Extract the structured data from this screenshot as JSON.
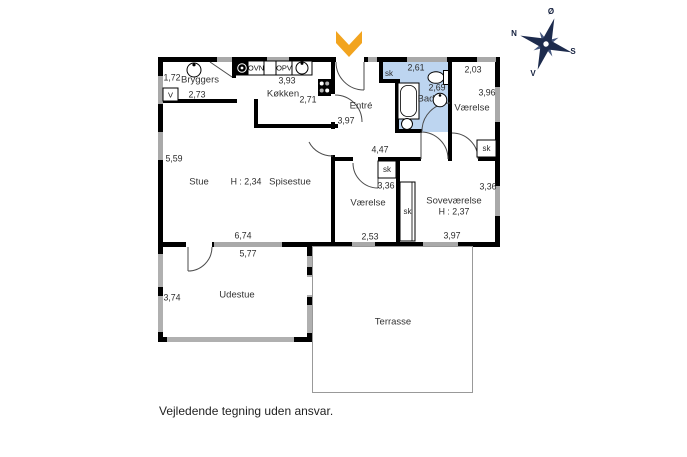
{
  "disclaimer": "Vejledende tegning uden ansvar.",
  "compass": {
    "north": "N",
    "south": "S",
    "east": "Ø",
    "west": "V"
  },
  "labels": {
    "oven": "OVN",
    "dishwasher": "OPV",
    "ventilation": "V",
    "closet": "sk"
  },
  "rooms": {
    "bryggers": {
      "name": "Bryggers",
      "width": "2,73",
      "depth": "1,72"
    },
    "kokken": {
      "name": "Køkken",
      "width": "3,93",
      "depth": "2,71"
    },
    "entre": {
      "name": "Entré",
      "depth": "3,97"
    },
    "bad": {
      "name": "Bad",
      "width": "2,61",
      "depth": "2,69"
    },
    "vaerelse_ne": {
      "name": "Værelse",
      "width": "2,03",
      "depth": "3,96"
    },
    "hall": {
      "width": "4,47"
    },
    "stue": {
      "name": "Stue",
      "ceiling_height": "H : 2,34",
      "depth": "5,59",
      "width": "6,74"
    },
    "spisestue": {
      "name": "Spisestue"
    },
    "vaerelse_s": {
      "name": "Værelse",
      "width": "2,53",
      "depth": "3,36"
    },
    "sovevaerelse": {
      "name": "Soveværelse",
      "ceiling_height": "H : 2,37",
      "width": "3,97",
      "depth": "3,36"
    },
    "udestue": {
      "name": "Udestue",
      "width": "5,77",
      "depth": "3,74"
    },
    "terrasse": {
      "name": "Terrasse"
    }
  },
  "colors": {
    "bathroom_fill": "#bdd5f0",
    "entrance_arrow": "#f2a41f",
    "compass": "#1d2b4d",
    "wall": "#000000",
    "window": "#a9a9a9"
  }
}
